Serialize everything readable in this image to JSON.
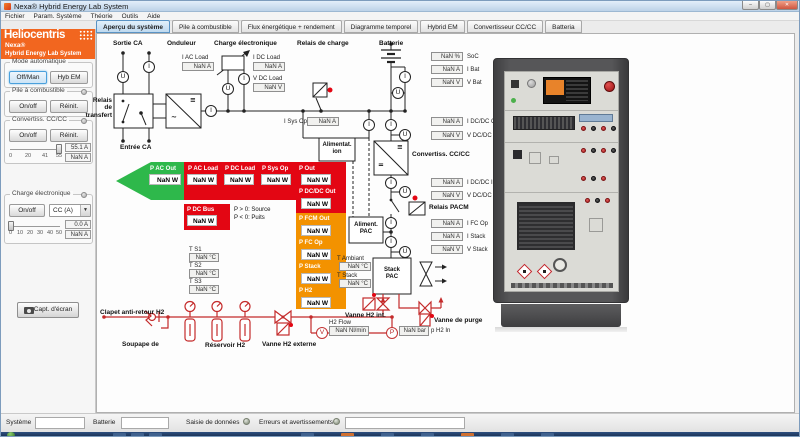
{
  "window": {
    "title": "Nexa® Hybrid Energy Lab System",
    "minimize": "–",
    "maximize": "▢",
    "close": "✕"
  },
  "menu": {
    "items": [
      "Fichier",
      "Param. Système",
      "Théorie",
      "Outils",
      "Aide"
    ]
  },
  "tabs": [
    {
      "label": "Aperçu du système",
      "selected": true
    },
    {
      "label": "Pile à combustible",
      "selected": false
    },
    {
      "label": "Flux énergétique + rendement",
      "selected": false
    },
    {
      "label": "Diagramme temporel",
      "selected": false
    },
    {
      "label": "Hybrid EM",
      "selected": false
    },
    {
      "label": "Convertisseur CC/CC",
      "selected": false
    },
    {
      "label": "Batteria",
      "selected": false
    }
  ],
  "sidebar": {
    "brand": {
      "name": "Heliocentris",
      "product": "Nexa®",
      "subtitle": "Hybrid Energy Lab System"
    },
    "mode_group": {
      "title": "Mode automatique",
      "btn_offman": "Off/Man",
      "btn_hybem": "Hyb EM"
    },
    "fc_group": {
      "title": "Pile à combustible",
      "btn_on": "On/off",
      "btn_reset": "Réinit."
    },
    "conv_group": {
      "title": "Convertiss. CC/CC",
      "btn_on": "On/off",
      "btn_reset": "Réinit.",
      "ticks": [
        "0",
        "20",
        "41",
        "55"
      ],
      "value_set": "55.1 A",
      "value_actual": "NaN A"
    },
    "load_group": {
      "title": "Charge électronique",
      "btn_on": "On/off",
      "dropdown": "CC (A)",
      "dropdown_caret": "▼",
      "ticks": [
        "0",
        "10",
        "20",
        "30",
        "40",
        "50"
      ],
      "value_set": "0.0 A",
      "value_actual": "NaN A"
    },
    "screenshot_btn": "Capt. d'écran"
  },
  "diagram": {
    "labels": {
      "sortie_ca": "Sortie CA",
      "onduleur": "Onduleur",
      "charge_electronique": "Charge électronique",
      "relais_charge": "Relais de charge",
      "batterie": "Batterie",
      "relais_transfert": "Relais de transfert",
      "entree_ca": "Entrée CA",
      "convertisseur": "Convertiss. CC/CC",
      "relais_pacm": "Relais PACM",
      "alim1": "Alimentat.",
      "alim2": "ion",
      "alimpac1": "Aliment.",
      "alimpac2": "PAC",
      "stack1": "Stack",
      "stack2": "PAC",
      "clapet": "Clapet anti-retour H2",
      "soupape": "Soupape de",
      "reservoir": "Réservoir H2",
      "vanne_ext": "Vanne H2 externe",
      "vanne_int": "Vanne H2 int.",
      "vanne_purge": "Vanne de purge",
      "note1": "P > 0: Source",
      "note2": "P < 0: Puits"
    },
    "symbols": {
      "dc": "≡",
      "dc_low": "=",
      "ac": "~",
      "i": "I",
      "u": "U",
      "v": "V",
      "p": "P"
    },
    "fields": [
      {
        "label": "I AC Load",
        "value": "NaN A"
      },
      {
        "label": "I DC Load",
        "value": "NaN A"
      },
      {
        "label": "V DC Load",
        "value": "NaN V"
      },
      {
        "label": "SoC",
        "value": "NaN %"
      },
      {
        "label": "I Bat",
        "value": "NaN A"
      },
      {
        "label": "V Bat",
        "value": "NaN V"
      },
      {
        "label": "I DC/DC Out",
        "value": "NaN A"
      },
      {
        "label": "V DC/DC Out",
        "value": "NaN V"
      },
      {
        "label": "I DC/DC In",
        "value": "NaN A"
      },
      {
        "label": "V DC/DC In",
        "value": "NaN V"
      },
      {
        "label": "I FC Op",
        "value": "NaN A"
      },
      {
        "label": "I Stack",
        "value": "NaN A"
      },
      {
        "label": "V Stack",
        "value": "NaN V"
      },
      {
        "label": "I Sys Op",
        "value": "NaN A"
      },
      {
        "label": "T Ambiant",
        "value": "NaN °C"
      },
      {
        "label": "T Stack",
        "value": "NaN °C"
      },
      {
        "label": "T S1",
        "value": "NaN °C"
      },
      {
        "label": "T S2",
        "value": "NaN °C"
      },
      {
        "label": "T S3",
        "value": "NaN °C"
      },
      {
        "label": "H2 Flow",
        "value": "NaN Nl/min"
      },
      {
        "label": "p H2 In",
        "value": "NaN bar"
      }
    ],
    "power": [
      {
        "label": "P AC Out",
        "value": "NaN W"
      },
      {
        "label": "P AC Load",
        "value": "NaN W"
      },
      {
        "label": "P DC Load",
        "value": "NaN W"
      },
      {
        "label": "P Sys Op",
        "value": "NaN W"
      },
      {
        "label": "P Out",
        "value": "NaN W"
      },
      {
        "label": "P DC Bus",
        "value": "NaN W"
      },
      {
        "label": "P DC/DC Out",
        "value": "NaN W"
      },
      {
        "label": "P FCM Out",
        "value": "NaN W"
      },
      {
        "label": "P FC Op",
        "value": "NaN W"
      },
      {
        "label": "P Stack",
        "value": "NaN W"
      },
      {
        "label": "P H2",
        "value": "NaN W"
      }
    ],
    "colors": {
      "flow_green": "#2eb84b",
      "flow_red": "#e30613",
      "flow_orange": "#f39200",
      "pipe_red": "#c42b2b",
      "brand_orange": "#f2661f",
      "tab_blue": "#bed9ef"
    }
  },
  "statusbar": {
    "system": "Système",
    "battery": "Batterie",
    "data_entry": "Saisie de données",
    "errors": "Erreurs et avertissements"
  }
}
